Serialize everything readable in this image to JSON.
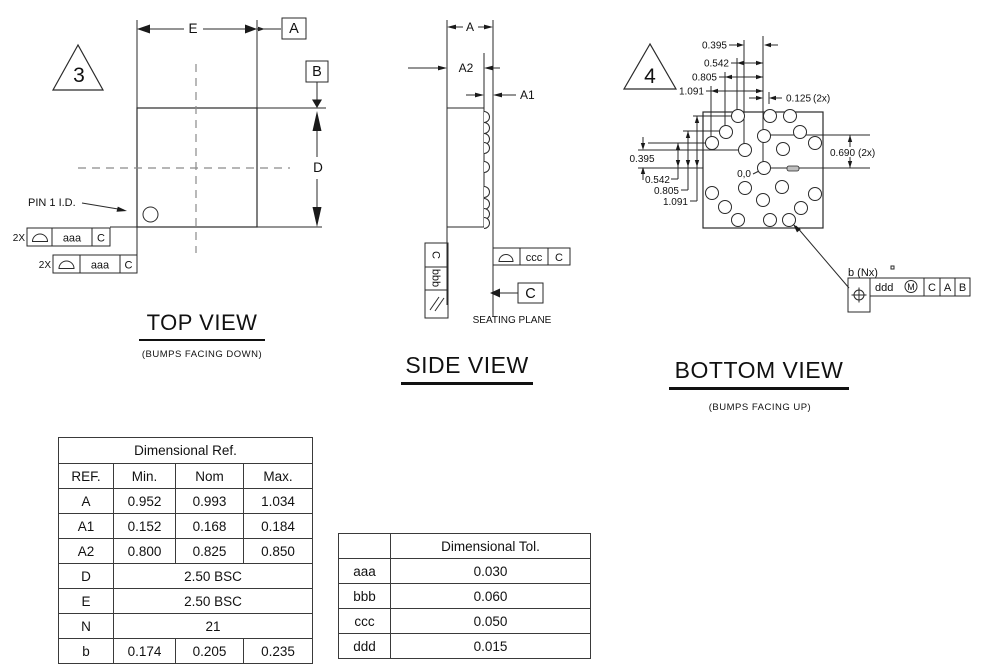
{
  "views": {
    "top": {
      "title": "TOP VIEW",
      "subtitle": "(BUMPS FACING DOWN)",
      "flag": "3",
      "dim_e": "E",
      "datum_a": "A",
      "datum_b": "B",
      "dim_d": "D",
      "pin1_label": "PIN 1 I.D.",
      "fcf1": {
        "qty": "2X",
        "tol": "aaa",
        "datum": "C"
      },
      "fcf2": {
        "qty": "2X",
        "tol": "aaa",
        "datum": "C"
      }
    },
    "side": {
      "title": "SIDE VIEW",
      "dim_a": "A",
      "dim_a1": "A1",
      "dim_a2": "A2",
      "fcf_parallelism": {
        "tol": "bbb",
        "datum": "C"
      },
      "fcf_profile": {
        "tol": "ccc",
        "datum": "C"
      },
      "datum_c": "C",
      "seating_plane": "SEATING PLANE",
      "bump_y": [
        117,
        128,
        139,
        148,
        167,
        192,
        204,
        214,
        223
      ]
    },
    "bottom": {
      "title": "BOTTOM VIEW",
      "subtitle": "(BUMPS FACING UP)",
      "flag": "4",
      "top_dims": [
        "0.395",
        "0.542",
        "0.805",
        "1.091"
      ],
      "left_dims": [
        "0.395",
        "0.542",
        "0.805",
        "1.091"
      ],
      "pitch_dim": "0.125",
      "pitch_qty": "(2x)",
      "row_dim": "0.690",
      "row_qty": "(2x)",
      "origin": "0,0",
      "bump_callout": "b (Nx)",
      "fcf_position": {
        "tol": "ddd",
        "modifier": "M",
        "datum1": "C",
        "datum2": "A",
        "datum3": "B"
      },
      "bumps": [
        [
          738,
          116
        ],
        [
          770,
          116
        ],
        [
          790,
          116
        ],
        [
          726,
          132
        ],
        [
          800,
          132
        ],
        [
          764,
          136
        ],
        [
          712,
          143
        ],
        [
          815,
          143
        ],
        [
          745,
          150
        ],
        [
          783,
          149
        ],
        [
          764,
          168
        ],
        [
          745,
          188
        ],
        [
          782,
          187
        ],
        [
          712,
          193
        ],
        [
          815,
          194
        ],
        [
          763,
          200
        ],
        [
          725,
          207
        ],
        [
          801,
          208
        ],
        [
          738,
          220
        ],
        [
          770,
          220
        ],
        [
          789,
          220
        ]
      ]
    }
  },
  "tables": {
    "dim_ref": {
      "title": "Dimensional Ref.",
      "headers": [
        "REF.",
        "Min.",
        "Nom",
        "Max."
      ],
      "row_a": [
        "A",
        "0.952",
        "0.993",
        "1.034"
      ],
      "row_a1": [
        "A1",
        "0.152",
        "0.168",
        "0.184"
      ],
      "row_a2": [
        "A2",
        "0.800",
        "0.825",
        "0.850"
      ],
      "row_d": [
        "D",
        "2.50 BSC"
      ],
      "row_e": [
        "E",
        "2.50 BSC"
      ],
      "row_n": [
        "N",
        "21"
      ],
      "row_b": [
        "b",
        "0.174",
        "0.205",
        "0.235"
      ]
    },
    "dim_tol": {
      "title": "Dimensional Tol.",
      "rows": [
        [
          "aaa",
          "0.030"
        ],
        [
          "bbb",
          "0.060"
        ],
        [
          "ccc",
          "0.050"
        ],
        [
          "ddd",
          "0.015"
        ]
      ]
    }
  }
}
